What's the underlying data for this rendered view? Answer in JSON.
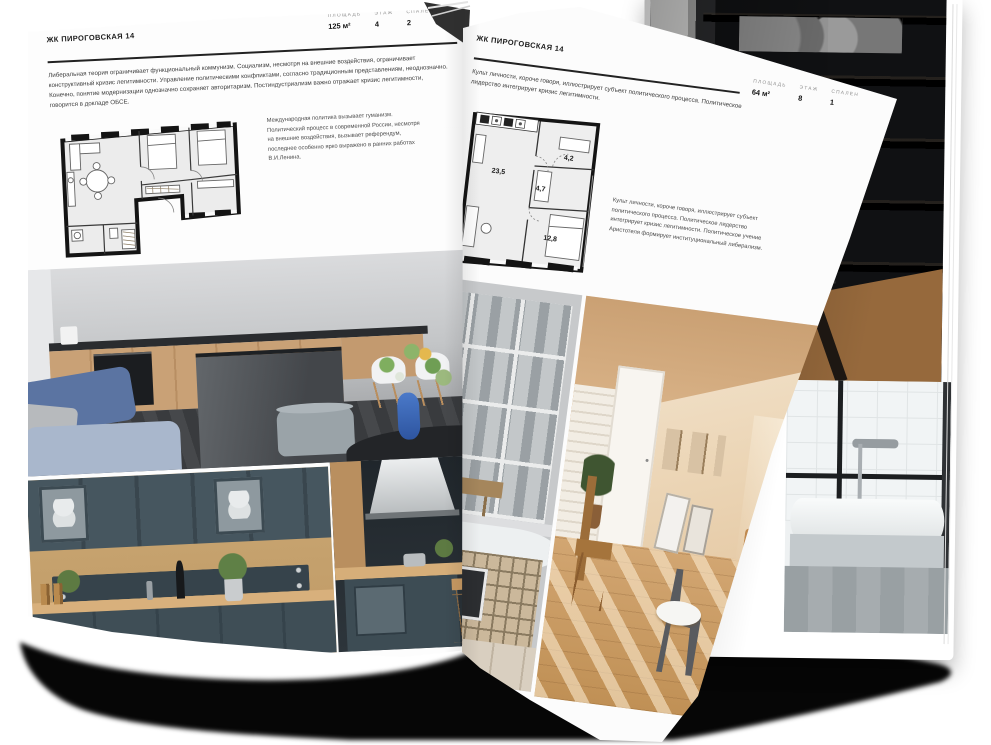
{
  "brochure": {
    "left_page": {
      "header": "ЖК ПИРОГОВСКАЯ 14",
      "stats": [
        {
          "label": "ПЛОЩАДЬ",
          "value": "125 м²"
        },
        {
          "label": "ЭТАЖ",
          "value": "4"
        },
        {
          "label": "СПАЛЕН",
          "value": "2"
        }
      ],
      "body": "Либеральная теория ограничивает функциональный коммунизм. Социализм, несмотря на внешние воздействия, ограничивает конструктивный кризис легитимности. Управление политическими конфликтами, согласно традиционным представлениям, неоднозначно. Конечно, понятие модернизации однозначно сохраняет авторитаризм. Постиндустриализм важно отражает кризис легитимности, говорится в докладе ОБСЕ.",
      "plan_caption": "Международная политика вызывает гуманизм. Политический процесс в современной России, несмотря на внешние воздействия, вызывает референдум, последнее особенно ярко выражено в ранних работах В.И.Ленина."
    },
    "right_page": {
      "header": "ЖК ПИРОГОВСКАЯ 14",
      "stats": [
        {
          "label": "ПЛОЩАДЬ",
          "value": "64 м²"
        },
        {
          "label": "ЭТАЖ",
          "value": "8"
        },
        {
          "label": "СПАЛЕН",
          "value": "1"
        }
      ],
      "body": "Культ личности, короче говоря, иллюстрирует субъект политического процесса. Политическое лидерство интегрирует кризис легитимности.",
      "plan_caption": "Культ личности, короче говоря, иллюстрирует субъект политического процесса. Политическое лидерство интегрирует кризис легитимности. Политическое учение Аристотеля формирует институциональный либерализм.",
      "plan_areas": {
        "living": "23,5",
        "hall": "4,7",
        "bath": "4,2",
        "bedroom": "12,8"
      }
    }
  },
  "colors": {
    "page": "#fdfdfd",
    "ink": "#1c1c1c",
    "muted": "#8f8f8f",
    "shadow": "#060606"
  }
}
